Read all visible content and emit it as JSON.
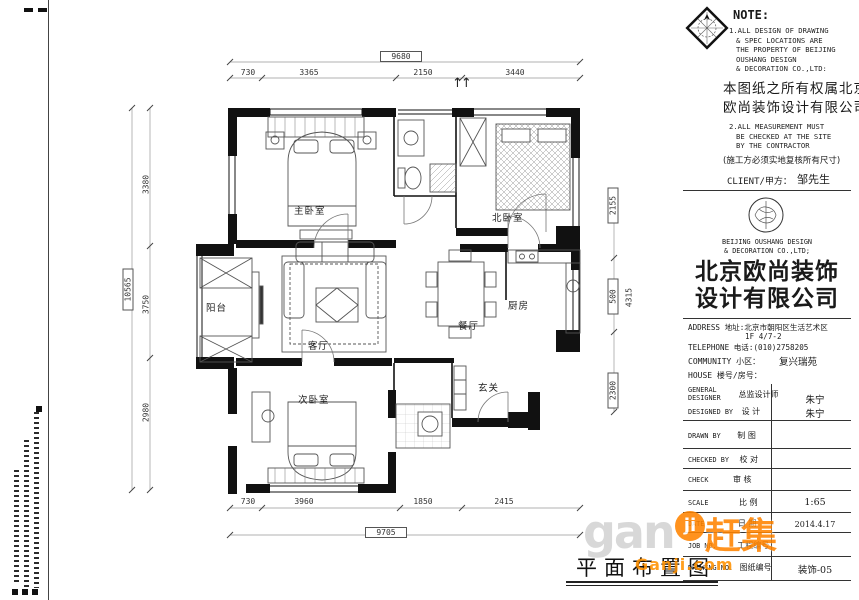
{
  "sheet": {
    "title": "平面布置图"
  },
  "note": {
    "heading": "NOTE:",
    "en1": [
      "1.ALL DESIGN OF DRAWING",
      "& SPEC LOCATIONS ARE",
      "THE PROPERTY OF BEIJING",
      "OUSHANG DESIGN",
      "& DECORATION CO.,LTD:"
    ],
    "cn1": "本图纸之所有权属北京",
    "cn2": "欧尚装饰设计有限公司",
    "en2": [
      "2.ALL MEASUREMENT MUST",
      "BE CHECKED AT THE SITE",
      "BY THE CONTRACTOR"
    ],
    "cn3": "(施工方必须实地复核所有尺寸)"
  },
  "client": {
    "label": "CLIENT/甲方：",
    "value": "邹先生"
  },
  "company": {
    "en1": "BEIJING OUSHANG DESIGN",
    "en2": "& DECORATION CO.,LTD;",
    "cn_line1": "北京欧尚装饰",
    "cn_line2": "设计有限公司"
  },
  "contact": {
    "address_line1": "ADDRESS 地址:北京市朝阳区生活艺术区",
    "address_line2": "1F 4/7-2",
    "phone": "TELEPHONE 电话:(010)2758205"
  },
  "project": {
    "community_label": "COMMUNITY 小区：",
    "community_value": "复兴瑞苑",
    "house_label": "HOUSE 楼号/房号：",
    "house_value": ""
  },
  "titleblock": {
    "rows": [
      {
        "en": "GENERAL DESIGNER",
        "cn": "总监设计师",
        "value": "朱宁"
      },
      {
        "en": "DESIGNED BY",
        "cn": "设 计",
        "value": "朱宁"
      },
      {
        "en": "DRAWN BY",
        "cn": "制 图",
        "value": ""
      },
      {
        "en": "CHECKED BY",
        "cn": "校 对",
        "value": ""
      },
      {
        "en": "CHECK",
        "cn": "审 核",
        "value": ""
      },
      {
        "en": "SCALE",
        "cn": "比 例",
        "value": "1:65"
      },
      {
        "en": "DATE",
        "cn": "日 期",
        "value": "2014.4.17"
      },
      {
        "en": "JOB NO.",
        "cn": "工程编号",
        "value": ""
      },
      {
        "en": "DRAWING NO.",
        "cn": "图纸编号",
        "value": "装饰-05"
      }
    ]
  },
  "plan": {
    "rooms": [
      {
        "label": "主卧室"
      },
      {
        "label": "北卧室"
      },
      {
        "label": "阳台"
      },
      {
        "label": "客厅"
      },
      {
        "label": "餐厅"
      },
      {
        "label": "厨房"
      },
      {
        "label": "玄关"
      },
      {
        "label": "次卧室"
      }
    ],
    "dims": {
      "top_total": "9680",
      "top": [
        "730",
        "3365",
        "2150",
        "3440"
      ],
      "bottom_total": "9705",
      "bottom": [
        "730",
        "3960",
        "1850",
        "2415"
      ],
      "left_total": "10565",
      "left": [
        "3380",
        "3750",
        "2980"
      ],
      "right": [
        "2155",
        "500",
        "4315",
        "2300"
      ]
    },
    "entry_arrows": "↑↑"
  },
  "watermark": {
    "gan": "gan",
    "ji": "ji",
    "cn": "赶集",
    "domain": "Ganji.com"
  },
  "colors": {
    "accent_orange": "#ff8400",
    "line": "#111111",
    "watermark_gray": "#d3d3d3"
  }
}
